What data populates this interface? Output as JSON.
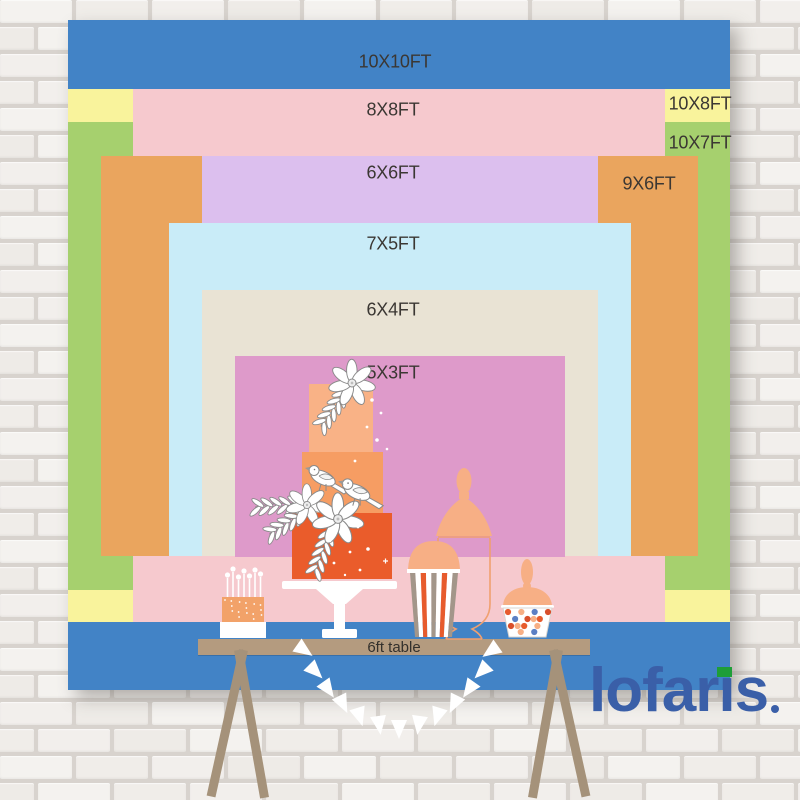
{
  "brand": {
    "logo_text": "lofaris",
    "logo_color": "#3a5fa8",
    "logo_accent_color": "#1e9e38"
  },
  "backdrop_chart": {
    "unit": "FT",
    "label_color": "#3b3733",
    "sizes": [
      {
        "label": "10X10FT",
        "width_ft": 10,
        "height_ft": 10,
        "color": "#4283c6",
        "rect": {
          "x": 68,
          "y": 20,
          "w": 662,
          "h": 670
        },
        "label_at": {
          "x": 395,
          "y": 62
        }
      },
      {
        "label": "10X8FT",
        "width_ft": 10,
        "height_ft": 8,
        "color": "#f9f39c",
        "rect": {
          "x": 68,
          "y": 89,
          "w": 662,
          "h": 533
        },
        "label_at": {
          "x": 700,
          "y": 104
        }
      },
      {
        "label": "10X7FT",
        "width_ft": 10,
        "height_ft": 7,
        "color": "#a6d06e",
        "rect": {
          "x": 68,
          "y": 122,
          "w": 662,
          "h": 468
        },
        "label_at": {
          "x": 700,
          "y": 143
        }
      },
      {
        "label": "8X8FT",
        "width_ft": 8,
        "height_ft": 8,
        "color": "#f6c9ce",
        "rect": {
          "x": 133,
          "y": 89,
          "w": 532,
          "h": 533
        },
        "label_at": {
          "x": 393,
          "y": 110
        }
      },
      {
        "label": "9X6FT",
        "width_ft": 9,
        "height_ft": 6,
        "color": "#eaa55e",
        "rect": {
          "x": 101,
          "y": 156,
          "w": 597,
          "h": 400
        },
        "label_at": {
          "x": 649,
          "y": 184
        }
      },
      {
        "label": "6X6FT",
        "width_ft": 6,
        "height_ft": 6,
        "color": "#dcbfee",
        "rect": {
          "x": 202,
          "y": 156,
          "w": 396,
          "h": 400
        },
        "label_at": {
          "x": 393,
          "y": 173
        }
      },
      {
        "label": "7X5FT",
        "width_ft": 7,
        "height_ft": 5,
        "color": "#c9ecf8",
        "rect": {
          "x": 169,
          "y": 223,
          "w": 462,
          "h": 333
        },
        "label_at": {
          "x": 393,
          "y": 244
        }
      },
      {
        "label": "6X4FT",
        "width_ft": 6,
        "height_ft": 4,
        "color": "#e9e3d4",
        "rect": {
          "x": 202,
          "y": 290,
          "w": 396,
          "h": 266
        },
        "label_at": {
          "x": 393,
          "y": 310
        }
      },
      {
        "label": "5X3FT",
        "width_ft": 5,
        "height_ft": 3,
        "color": "#de9aca",
        "rect": {
          "x": 235,
          "y": 356,
          "w": 330,
          "h": 201
        },
        "label_at": {
          "x": 393,
          "y": 373
        }
      }
    ]
  },
  "table": {
    "label": "6ft table",
    "text_color": "#33302c",
    "top_color": "#b49b7f",
    "leg_color": "#a5927a"
  },
  "decor": {
    "items": [
      "three-tier-cake",
      "candle-cake",
      "popcorn-box",
      "candy-cup",
      "apothecary-jar-outline",
      "pennant-banner"
    ],
    "palette": {
      "cake_top_tier": "#f9b286",
      "cake_middle_tier": "#f69d63",
      "cake_bottom_tier": "#ea5c2b",
      "peach": "#f7af85",
      "stripe_orange": "#e75b2d",
      "stripe_tan": "#a3968a",
      "sketch_outline": "#8a8a8a",
      "jar_outline": "#f0a070",
      "candy_blue": "#5b7fc4",
      "pennant_white": "#ffffff"
    }
  },
  "wall": {
    "brick_color": "#f3f1ee",
    "grout_color": "#d8d3ce"
  }
}
